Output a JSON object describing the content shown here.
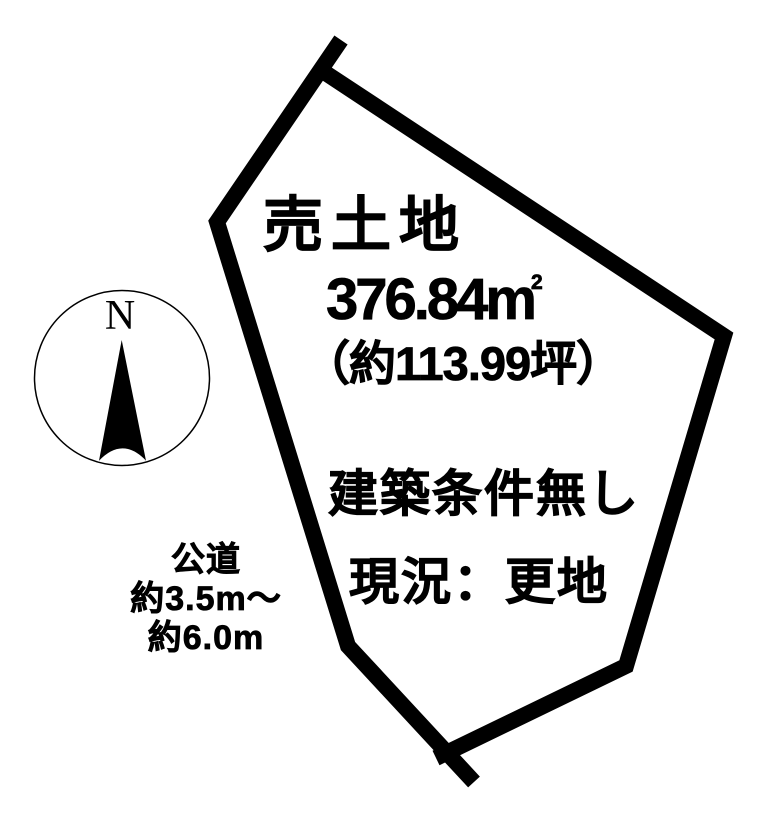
{
  "canvas": {
    "width": 773,
    "height": 819,
    "background_color": "#ffffff",
    "ink_color": "#000000"
  },
  "plot": {
    "label": "売土地",
    "area": {
      "value": "376.84",
      "unit": "m",
      "unit_exponent": "2",
      "tsubo": "（約113.99坪）"
    },
    "condition": "建築条件無し",
    "status": "現況：更地",
    "outline": {
      "left_polyline": "341,40 217,222 348,646 474,782",
      "right_polyline": "436,758 626,666 724,336 321,70"
    }
  },
  "road": {
    "name": "公道",
    "width_line1": "約3.5m～",
    "width_line2": "約6.0m"
  },
  "compass": {
    "north_label": "N",
    "needle_path": "M88.7,52 L66,172.7 Q89.5,148 113,172.7 Z"
  }
}
